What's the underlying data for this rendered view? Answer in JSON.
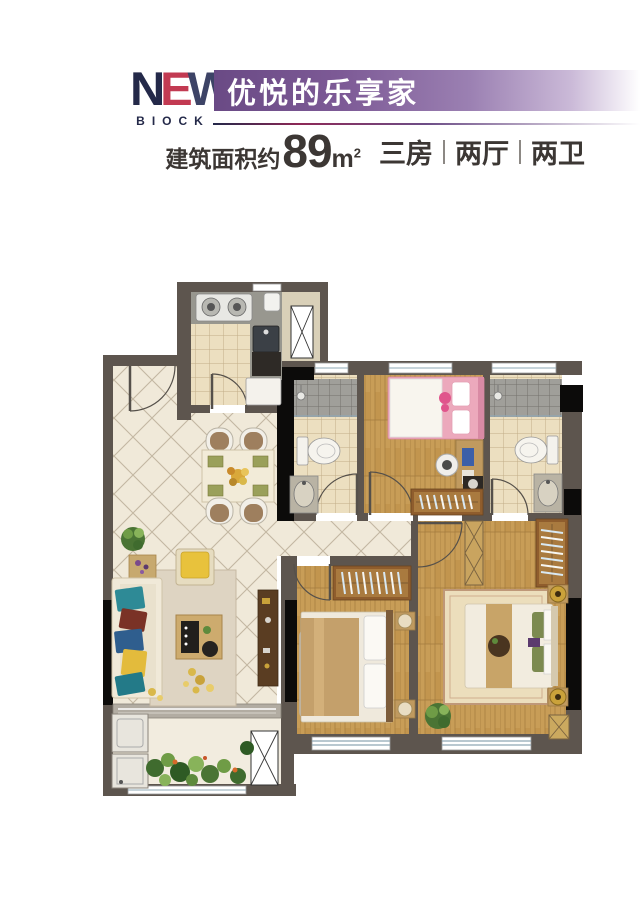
{
  "brand": {
    "logo_word_n": "N",
    "logo_word_e": "E",
    "logo_word_w": "W",
    "logo_sub": "BIOCK",
    "navy": "#242949",
    "red": "#c23a52"
  },
  "banner": {
    "title": "优悦的乐享家",
    "purple_dark": "#6a4a85",
    "purple_light": "#cbbad8",
    "text_color": "#ffffff"
  },
  "spec": {
    "area_label": "建筑面积约",
    "area_value": "89",
    "area_unit": "m",
    "area_exponent": "2",
    "layout_items": [
      "三房",
      "两厅",
      "两卫"
    ],
    "text_color": "#3c3734"
  },
  "floorplan": {
    "wall_color": "#5d554e",
    "column_color": "#0c0b0a",
    "tile_floor": "#f0e9d9",
    "tile_line": "#c3b7a2",
    "bath_floor": "#ecdfc0",
    "shower_floor": "#a09f9a",
    "wood_floor": "#c89d57",
    "balcony_floor": "#f2ecdf",
    "window_line": "#8fa8b5",
    "wardrobe": "#8f5d2d",
    "accent_pink_bed": "#eca9bc",
    "accent_sofa_teal": "#2e8a96",
    "accent_armchair_yellow": "#e8c23c",
    "plant_green": "#4a7434"
  }
}
